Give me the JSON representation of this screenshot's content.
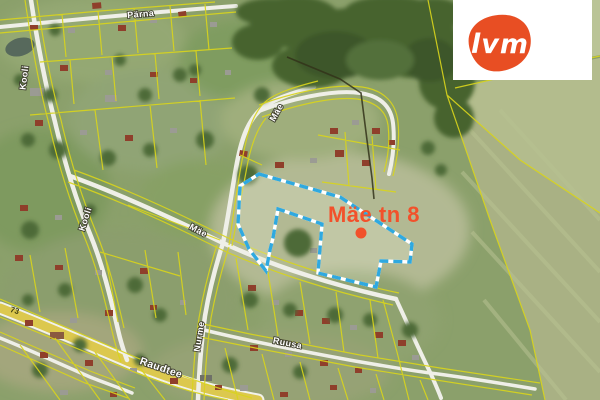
{
  "map": {
    "address_label": "Mäe tn 8",
    "label_color": "#f2512b",
    "marker_color": "#f2512b",
    "road_number": "73",
    "street_labels": [
      {
        "text": "Pärna"
      },
      {
        "text": "Kooli"
      },
      {
        "text": "Kooli"
      },
      {
        "text": "Mäe"
      },
      {
        "text": "Mäe"
      },
      {
        "text": "Nurme"
      },
      {
        "text": "Ruusa"
      },
      {
        "text": "Raudtee"
      }
    ],
    "parcel": {
      "outline_color": "#2fa9e0",
      "points": "259,174 340,197 412,244 410,262 381,261 376,287 318,273 322,224 278,209 273,238 270,250 266,271 249,249 238,224 240,186"
    }
  },
  "logo": {
    "text": "lvm",
    "background": "#ffffff",
    "blob_color": "#e84e23",
    "text_color": "#ffffff"
  }
}
